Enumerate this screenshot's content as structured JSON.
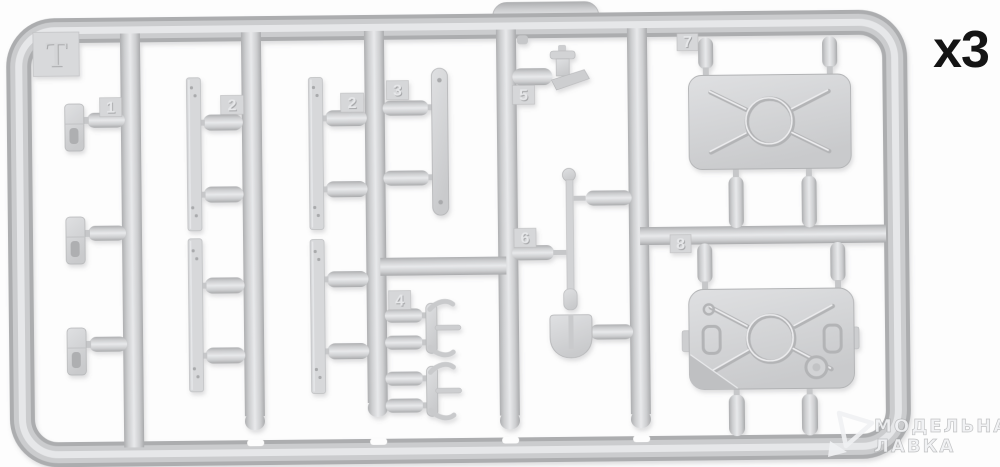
{
  "image_description": "Photo of an injection-molded plastic model kit sprue (light grey runner frame) with numbered attachment tabs and parts",
  "sprue": {
    "frame_letter": "T",
    "quantity_label": "x3",
    "part_tabs": {
      "p1": "1",
      "p2a": "2",
      "p2b": "2",
      "p3": "3",
      "p4": "4",
      "p5": "5",
      "p6": "6",
      "p7": "7",
      "p8": "8"
    }
  },
  "watermark": {
    "line1": "МОДЕЛЬНАЯ",
    "line2": "ЛАВКА"
  },
  "colors": {
    "background": "#fdfdfd",
    "plastic_base": "#d2d3d5",
    "plastic_highlight": "#e8e9eb",
    "plastic_shadow": "#aaabad",
    "quantity_text": "#141414",
    "watermark_text": "#f0f1f3"
  }
}
